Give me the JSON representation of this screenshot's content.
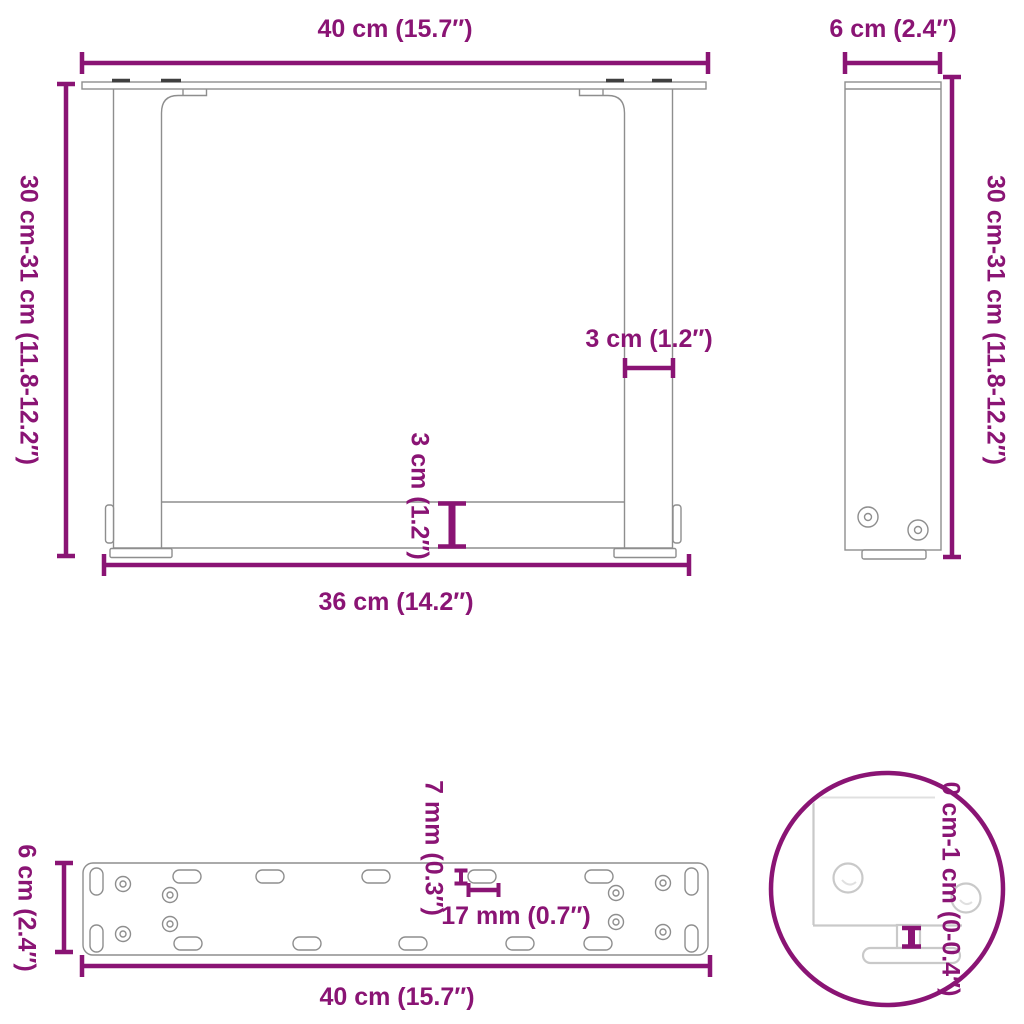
{
  "colors": {
    "dimension": "#8a1474",
    "outline": "#8e8e8e",
    "faded_outline": "#c9c9c9",
    "background": "#ffffff"
  },
  "views": {
    "front": {
      "width_top": "40 cm (15.7″)",
      "height_left": "30 cm-31 cm (11.8-12.2″)",
      "leg_width": "3 cm (1.2″)",
      "bar_height": "3 cm (1.2″)",
      "width_bottom": "36 cm (14.2″)"
    },
    "side": {
      "depth_top": "6 cm (2.4″)",
      "height_right": "30 cm-31 cm (11.8-12.2″)"
    },
    "plate": {
      "depth_left": "6 cm (2.4″)",
      "slot_height": "7 mm (0.3″)",
      "slot_width": "17 mm (0.7″)",
      "width_bottom": "40 cm (15.7″)"
    },
    "detail": {
      "adjust_range": "0 cm-1 cm (0-0.4″)"
    }
  }
}
